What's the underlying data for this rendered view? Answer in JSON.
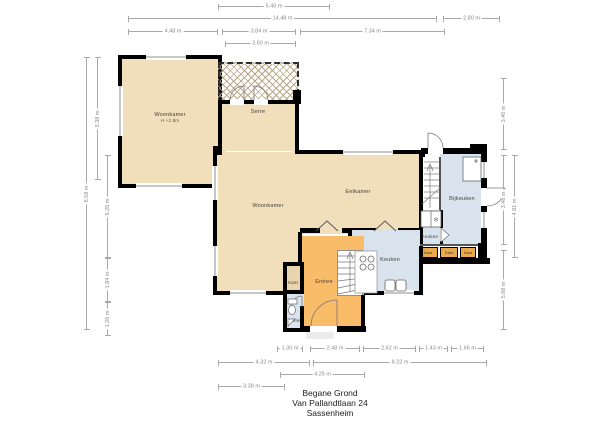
{
  "title_block": {
    "floor": "Begane Grond",
    "address": "Van Pallandtlaan 24",
    "city": "Sassenheim"
  },
  "rooms": {
    "woonkamer_tl": {
      "label": "Woonkamer",
      "height_note": "H +2.8m"
    },
    "serre": {
      "label": "Serre"
    },
    "eetkamer": {
      "label": "Eetkamer"
    },
    "woonkamer": {
      "label": "Woonkamer"
    },
    "keuken": {
      "label": "Keuken"
    },
    "keuken_klein": {
      "label": "Keuken"
    },
    "bijkeuken": {
      "label": "Bijkeuken"
    },
    "entree": {
      "label": "Entree"
    },
    "toilet": {
      "label": "Toilet"
    },
    "kast_hal": {
      "label": "Kast"
    },
    "kast_1": {
      "label": "Kast"
    },
    "kast_2": {
      "label": "Kast"
    },
    "kast_3": {
      "label": "Kast"
    }
  },
  "dimensions": {
    "top": {
      "d540": "5.40 m",
      "d1448": "14.48 m",
      "d280": "2.80 m",
      "d448": "4.48 m",
      "d384": "3.84 m",
      "d734": "7.34 m",
      "d360": "3.60 m"
    },
    "left": {
      "d658": "6.58 m",
      "d538": "5.38 m",
      "d620": "6.20 m",
      "d184": "1.84 m",
      "d126": "1.26 m"
    },
    "right": {
      "d340": "3.40 m",
      "d348": "3.48 m",
      "d588": "5.88 m",
      "d481": "4.81 m"
    },
    "bottom": {
      "d130": "1.30 m",
      "d248": "2.48 m",
      "d262": "2.62 m",
      "d143": "1.43 m",
      "d166": "1.66 m",
      "d432": "4.32 m",
      "d832": "8.32 m",
      "d425": "4.25 m",
      "d338": "3.38 m"
    }
  },
  "icons": {
    "freezer": "❄"
  },
  "colors": {
    "beige": "#f1debb",
    "orange": "#f9bc68",
    "blue": "#d9e3ee",
    "kast": "#eaa94e",
    "wall": "#000000",
    "dim": "#a9a9a9"
  }
}
